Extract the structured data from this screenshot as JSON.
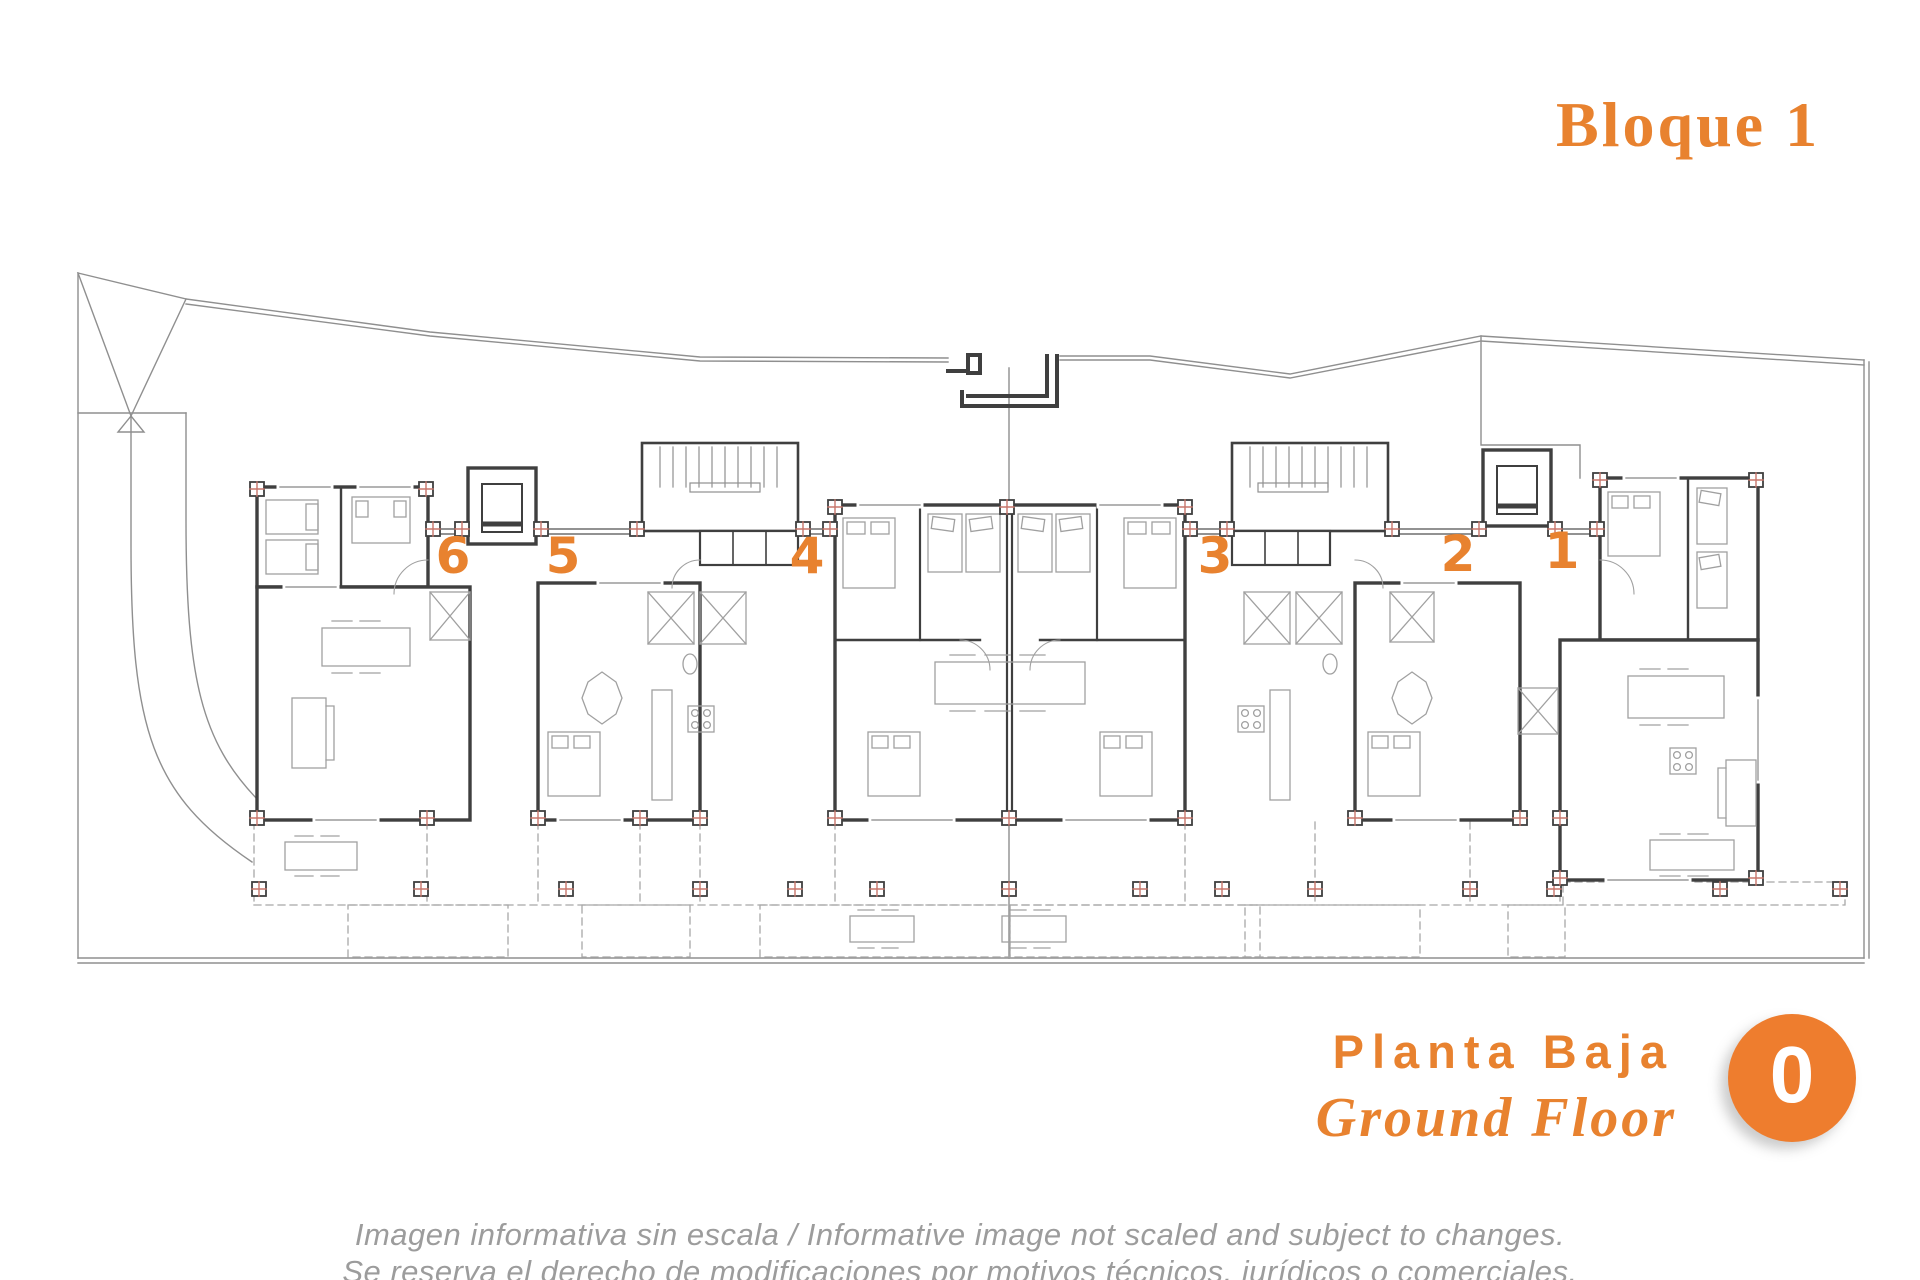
{
  "block": {
    "title": "Bloque 1"
  },
  "plan": {
    "name": "floor-plan-bloque-1",
    "unit_labels": [
      "6",
      "5",
      "4",
      "3",
      "2",
      "1"
    ]
  },
  "floor": {
    "title_es": "Planta Baja",
    "title_en": "Ground Floor",
    "level_badge": "0"
  },
  "disclaimer": {
    "line1": "Imagen informativa sin escala /  Informative image not scaled and subject to changes.",
    "line2": "Se reserva el derecho de modificaciones por motivos técnicos, jurídicos o comerciales."
  },
  "colors": {
    "accent": "#E8822F",
    "badge": "#EE7D2E",
    "wall": "#3F3F3F",
    "site_line": "#8F8F8F",
    "furniture": "#A0A0A0",
    "column_cross": "#C8766B"
  }
}
